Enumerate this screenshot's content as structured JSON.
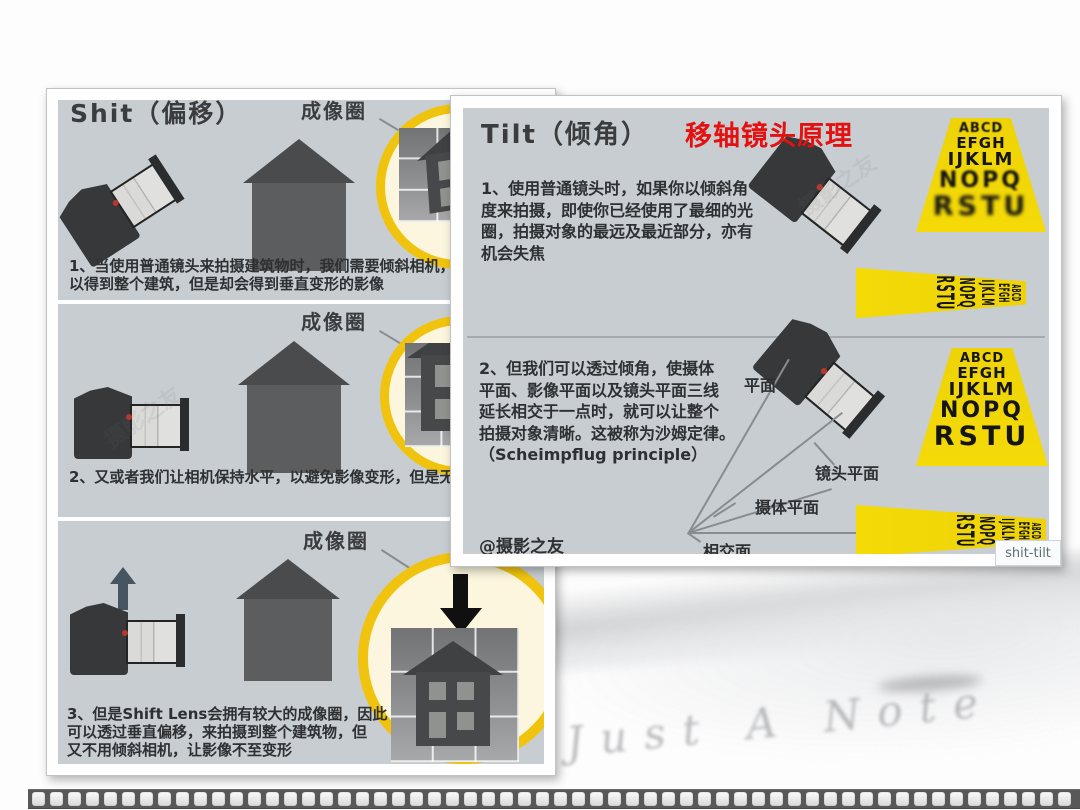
{
  "slide": {
    "red_title": "移轴镜头原理",
    "tooltip_label": "shit-tilt",
    "watermark_text": "Just A Note",
    "watermark_cn": "摄影之友",
    "colors": {
      "panel_background": "#c7cdd1",
      "imaging_circle_yellow": "#f0c40e",
      "chart_yellow": "#f2d409",
      "red_title": "#e51010",
      "dark_text": "#2e3032"
    }
  },
  "left_panel": {
    "title": "Shit（偏移）",
    "imaging_circle_label": "成像圈",
    "captions": [
      [
        "1、当使用普通镜头来拍摄建筑物时，我们需要倾斜相机，",
        "以得到整个建筑，但是却会得到垂直变形的影像"
      ],
      [
        "2、又或者我们让相机保持水平，以避免影像变形，但是无法拍摄到"
      ],
      [
        "3、但是Shift Lens会拥有较大的成像圈，因此",
        "可以透过垂直偏移，来拍摄到整个建筑物，但",
        "又不用倾斜相机，让影像不至变形"
      ]
    ]
  },
  "right_panel": {
    "title": "Tilt（倾角）",
    "paragraphs": [
      [
        "1、使用普通镜头时，如果你以倾斜角",
        "度来拍摄，即使你已经使用了最细的光",
        "圈，拍摄对象的最远及最近部分，亦有",
        "机会失焦"
      ],
      [
        "2、但我们可以透过倾角，使摄体",
        "平面、影像平面以及镜头平面三线",
        "延长相交于一点时，就可以让整个",
        "拍摄对象清晰。这被称为沙姆定律。",
        "（Scheimpflug principle）"
      ]
    ],
    "credit": "@摄影之友",
    "labels": {
      "plane": "平面",
      "lens_plane": "镜头平面",
      "subject_plane": "摄体平面",
      "intersect_plane": "相交面"
    },
    "letter_rows": [
      "ABCD",
      "EFGH",
      "IJKLM",
      "NOPQ",
      "RSTU"
    ]
  }
}
